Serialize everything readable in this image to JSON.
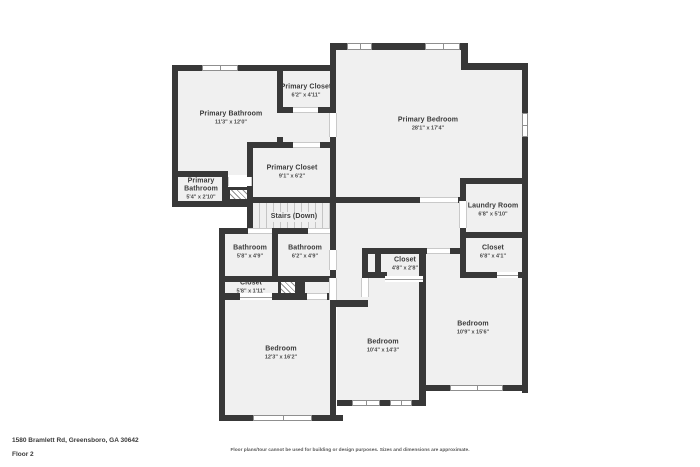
{
  "palette": {
    "wall": "#383838",
    "room_fill": "#f0f0f0",
    "text": "#3a3a3a",
    "stair_line": "#c5c5c5",
    "window_border": "#8f8f8f"
  },
  "rooms": {
    "primary_bathroom_main": {
      "name": "Primary Bathroom",
      "dims": "11'3\" x 12'0\""
    },
    "primary_closet_top": {
      "name": "Primary Closet",
      "dims": "6'2\" x 4'11\""
    },
    "primary_bedroom": {
      "name": "Primary Bedroom",
      "dims": "28'1\" x 17'4\""
    },
    "primary_bathroom_small": {
      "name": "Primary Bathroom",
      "dims": "5'4\" x 2'10\""
    },
    "primary_closet_lower": {
      "name": "Primary Closet",
      "dims": "9'1\" x 6'2\""
    },
    "stairs": {
      "name": "Stairs (Down)"
    },
    "laundry_room": {
      "name": "Laundry Room",
      "dims": "6'8\" x 5'10\""
    },
    "bathroom_left": {
      "name": "Bathroom",
      "dims": "5'8\" x 4'9\""
    },
    "bathroom_right": {
      "name": "Bathroom",
      "dims": "6'2\" x 4'9\""
    },
    "closet_hall": {
      "name": "Closet",
      "dims": "4'8\" x 2'8\""
    },
    "closet_right": {
      "name": "Closet",
      "dims": "6'8\" x 4'1\""
    },
    "closet_left": {
      "name": "Closet",
      "dims": "5'8\" x 1'11\""
    },
    "bedroom_left": {
      "name": "Bedroom",
      "dims": "12'3\" x 16'2\""
    },
    "bedroom_middle": {
      "name": "Bedroom",
      "dims": "10'4\" x 14'3\""
    },
    "bedroom_right": {
      "name": "Bedroom",
      "dims": "10'9\" x 15'6\""
    }
  },
  "footer": {
    "address": "1580 Bramlett Rd, Greensboro, GA 30642",
    "floor": "Floor 2",
    "disclaimer": "Floor plans/tour cannot be used for building or design purposes. Sizes and dimensions are approximate."
  }
}
